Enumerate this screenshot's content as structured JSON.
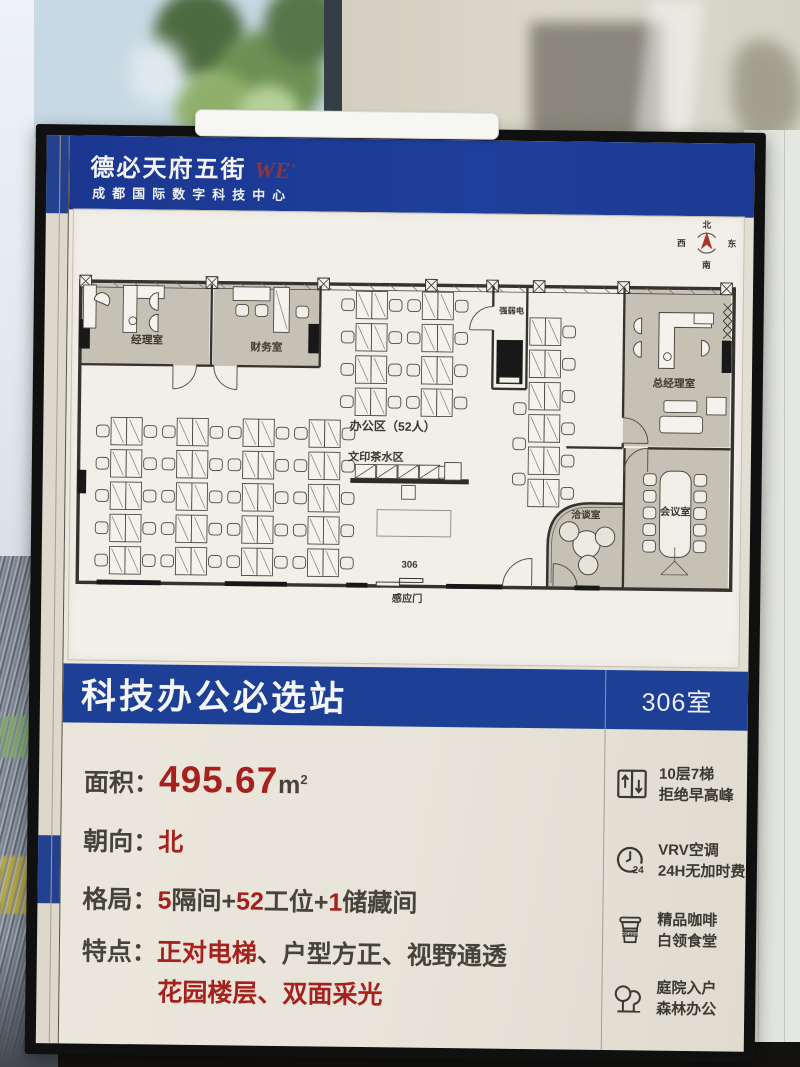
{
  "header": {
    "brand": "德必天府五街",
    "brand_mark": "WE",
    "brand_mark_sup": "+",
    "tagline": "成都国际数字科技中心"
  },
  "compass": {
    "north": "北",
    "east": "东",
    "south": "南",
    "west": "西"
  },
  "plan": {
    "rooms": {
      "manager": "经理室",
      "finance": "财务室",
      "utility": "强弱电",
      "general_manager": "总经理室",
      "meeting": "会议室",
      "negotiation": "洽谈室"
    },
    "labels": {
      "office_area": "办公区（52人）",
      "print_tea": "文印茶水区",
      "room_number": "306",
      "sensor_door": "感应门"
    }
  },
  "banner": {
    "title": "科技办公必选站",
    "room": "306室"
  },
  "details": {
    "area_label": "面积：",
    "area_value": "495.67",
    "area_unit": "m",
    "area_unit_sup": "2",
    "facing_label": "朝向：",
    "facing_value": "北",
    "layout_label": "格局：",
    "layout_parts": [
      {
        "t": "5",
        "red": true
      },
      {
        "t": "隔间+"
      },
      {
        "t": "52",
        "red": true
      },
      {
        "t": "工位+"
      },
      {
        "t": "1",
        "red": true
      },
      {
        "t": "储藏间"
      }
    ],
    "features_label": "特点：",
    "features_line1_parts": [
      {
        "t": "正对电梯",
        "red": true
      },
      {
        "t": "、户型方正、视野通透"
      }
    ],
    "features_line2_parts": [
      {
        "t": "花园楼层",
        "red": true
      },
      {
        "t": "、",
        "red": false
      },
      {
        "t": "双面采光",
        "red": true
      }
    ]
  },
  "amenities": [
    {
      "icon": "elevator-icon",
      "line1": "10层7梯",
      "line2": "拒绝早高峰"
    },
    {
      "icon": "clock-24-icon",
      "line1": "VRV空调",
      "line2": "24H无加时费"
    },
    {
      "icon": "coffee-icon",
      "line1": "精品咖啡",
      "line2": "白领食堂"
    },
    {
      "icon": "trees-icon",
      "line1": "庭院入户",
      "line2": "森林办公"
    }
  ],
  "icon_text": {
    "coffee": "COFFEE",
    "clock": "24"
  },
  "colors": {
    "header_blue": "#1d3b96",
    "banner_blue": "#1d3f96",
    "accent_red": "#a6201c",
    "poster_cream": "#e9e5da",
    "room_gray": "#c6c1b5"
  }
}
